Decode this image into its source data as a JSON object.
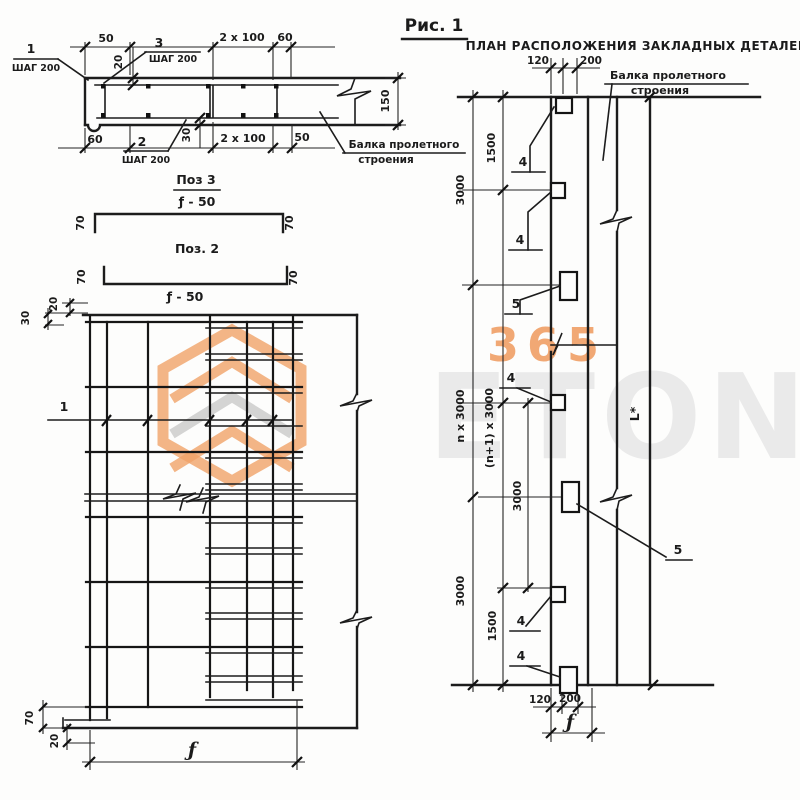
{
  "header": {
    "fig_title": "Рис. 1",
    "plan_title": "ПЛАН РАСПОЛОЖЕНИЯ ЗАКЛАДНЫХ ДЕТАЛЕЙ"
  },
  "section_view": {
    "dim_50_top": "50",
    "mark3": "3",
    "step3": "ШАГ 200",
    "dim_2x100_top": "2 x 100",
    "dim_60_top": "60",
    "dim_20": "20",
    "mark1": "1",
    "step1": "ШАГ 200",
    "dim_150": "150",
    "dim_60_bot": "60",
    "mark2": "2",
    "step2": "ШАГ 200",
    "dim_30": "30",
    "dim_2x100_bot": "2 x 100",
    "dim_50_bot": "50",
    "beam_label1": "Балка пролетного",
    "beam_label2": "строения"
  },
  "pos3_detail": {
    "title": "Поз 3",
    "sub": "ƒ - 50",
    "dim_left": "70",
    "dim_right": "70"
  },
  "pos2_detail": {
    "title": "Поз. 2",
    "sub": "ƒ - 50",
    "dim_left": "70",
    "dim_right": "70"
  },
  "mesh_view": {
    "dim_20_top": "20",
    "dim_30_top": "30",
    "mark1": "1",
    "dim_70_bot": "70",
    "dim_20_bot": "20",
    "dim_f": "ƒ"
  },
  "plan_view": {
    "dim_120_top": "120",
    "dim_200_top": "200",
    "beam_label1": "Балка пролетного",
    "beam_label2": "строения",
    "chain_3000_top": "3000",
    "chain_1500_top": "1500",
    "chain_n3000": "n x 3000",
    "chain_n1_3000": "(n+1) x 3000",
    "chain_3000_mid": "3000",
    "chain_3000_bot": "3000",
    "chain_1500_bot": "1500",
    "mark4": "4",
    "mark5": "5",
    "dim_L": "L*",
    "dim_120_bot": "120",
    "dim_200_bot": "200",
    "dim_f": "ƒ"
  },
  "watermark": {
    "digits": "365",
    "brand": "ETON"
  }
}
